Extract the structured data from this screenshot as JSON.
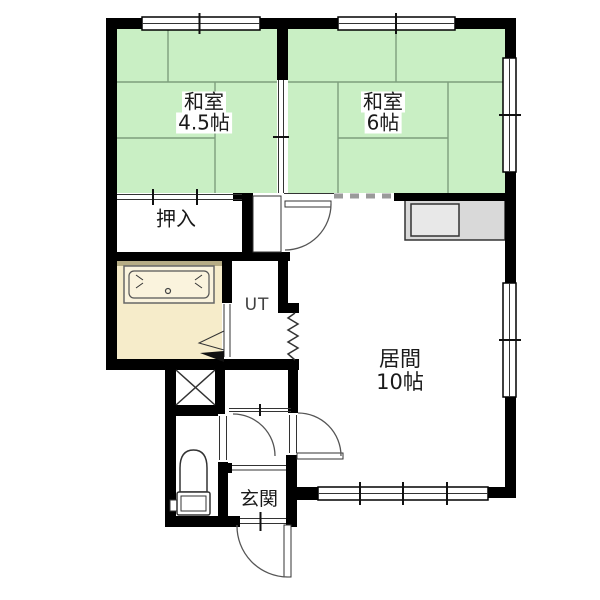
{
  "floor_plan": {
    "rooms": {
      "washitsu_45": {
        "name": "和室",
        "size": "4.5帖"
      },
      "washitsu_6": {
        "name": "和室",
        "size": "6帖"
      },
      "closet": {
        "label": "押入"
      },
      "utility": {
        "label": "UT"
      },
      "living": {
        "name": "居間",
        "size": "10帖"
      },
      "entrance": {
        "label": "玄関"
      }
    },
    "colors": {
      "tatami": "#c9efc4",
      "tatami_line": "#7d9e7d",
      "wall": "#000000",
      "bath": "#f6ecca",
      "bath_tub": "#faf3dd",
      "counter": "#d9d9d9",
      "line": "#333333",
      "text": "#1a1a1a"
    }
  }
}
